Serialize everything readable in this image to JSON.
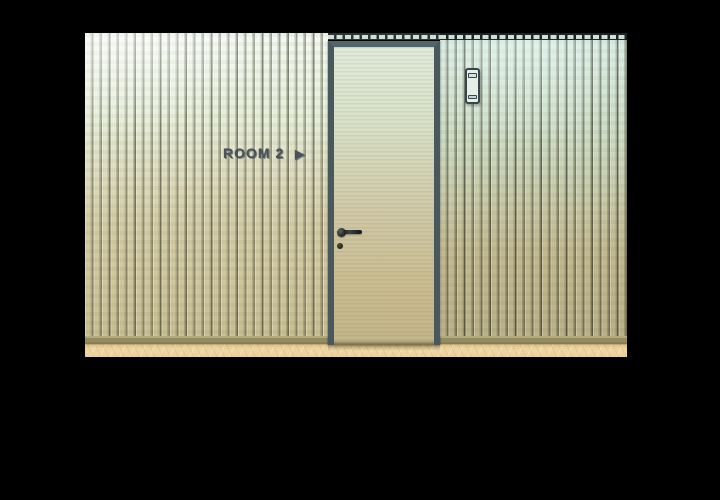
{
  "scene": {
    "description": "letterboxed 3D corridor render with slatted wood wall, door and card reader",
    "background_color": "#000000"
  },
  "sign": {
    "label": "ROOM 2",
    "arrow_icon": "▶",
    "text_color": "#49525c"
  },
  "colors": {
    "wall_left_top": "#f2f9f2",
    "wall_left_bottom": "#c9bf94",
    "wall_right_top": "#d9ece5",
    "wall_right_bottom": "#bab189",
    "slat_groove": "#55503a",
    "door_frame": "#49585d",
    "door_top": "#e1ebdb",
    "door_bottom": "#c2b588",
    "door_handle": "#23282a",
    "baseboard": "#938c62",
    "floor_wood": "#e9d09c",
    "card_reader_body": "#e4efe7",
    "card_reader_outline": "#36464b",
    "slat_top_notches": "#cfe0d6"
  }
}
